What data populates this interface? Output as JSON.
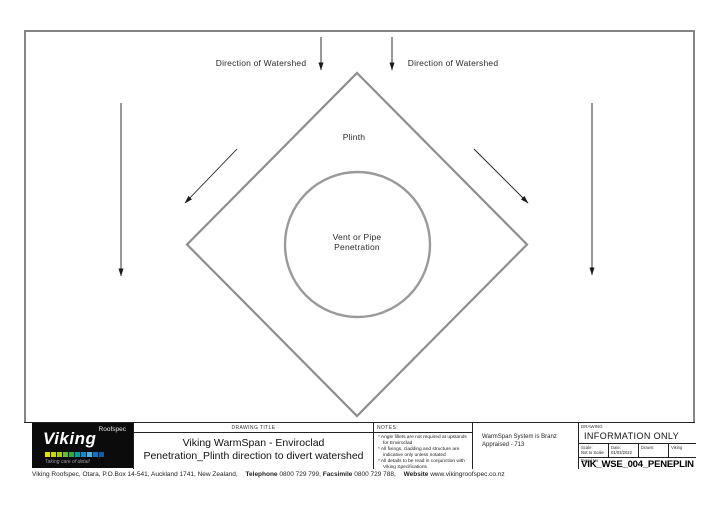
{
  "drawing": {
    "labels": {
      "watershed_left": "Direction of Watershed",
      "watershed_right": "Direction of Watershed",
      "plinth": "Plinth",
      "penetration_line1": "Vent or Pipe",
      "penetration_line2": "Penetration"
    },
    "colors": {
      "shape_stroke": "#8e8e8e",
      "circle_stroke": "#9a9a9a",
      "arrow": "#1a1a1a",
      "border": "#858585"
    }
  },
  "title_block": {
    "logo": {
      "brand": "Viking",
      "sub_brand": "Roofspec",
      "tagline": "Taking care of detail",
      "stripe_colors": [
        "#e3df00",
        "#cdd600",
        "#a3cc00",
        "#6cb82e",
        "#2fa83c",
        "#00a39a",
        "#0b8fd0",
        "#45b5e8",
        "#0a76c4",
        "#0a5fae"
      ]
    },
    "drawing_title": {
      "header": "DRAWING TITLE",
      "line1": "Viking WarmSpan - Enviroclad",
      "line2": "Penetration_Plinth direction to divert watershed"
    },
    "notes": {
      "header": "NOTES:",
      "items": [
        "* Angle fillets are not required at upstands for Enviroclad",
        "* All fixings, cladding and structure are indicative only unless notated",
        "* All details to be read in conjunction with Viking Specifications"
      ]
    },
    "appraisal": {
      "line1": "WarmSpan System is Branz",
      "line2": "Appraised - 713"
    },
    "info": {
      "header": "DRAWING",
      "status": "INFORMATION ONLY",
      "scale_label": "Scale:",
      "scale_value": "Not to Scale",
      "date_label": "Date:",
      "date_value": "01/03/2022",
      "drawn_label": "Drawn:",
      "drawn_value": "Viking",
      "detail_label": "Detail No",
      "detail_value": "VIK_WSE_004_PENEPLIN"
    }
  },
  "footer": {
    "address": "Viking Roofspec, Otara, P.O.Box 14-541, Auckland 1741, New Zealand,",
    "telephone_label": "Telephone",
    "telephone_value": "0800 729 799,",
    "facsimile_label": "Facsimile",
    "facsimile_value": "0800 729 788,",
    "website_label": "Website",
    "website_value": "www.vikingroofspec.co.nz"
  }
}
